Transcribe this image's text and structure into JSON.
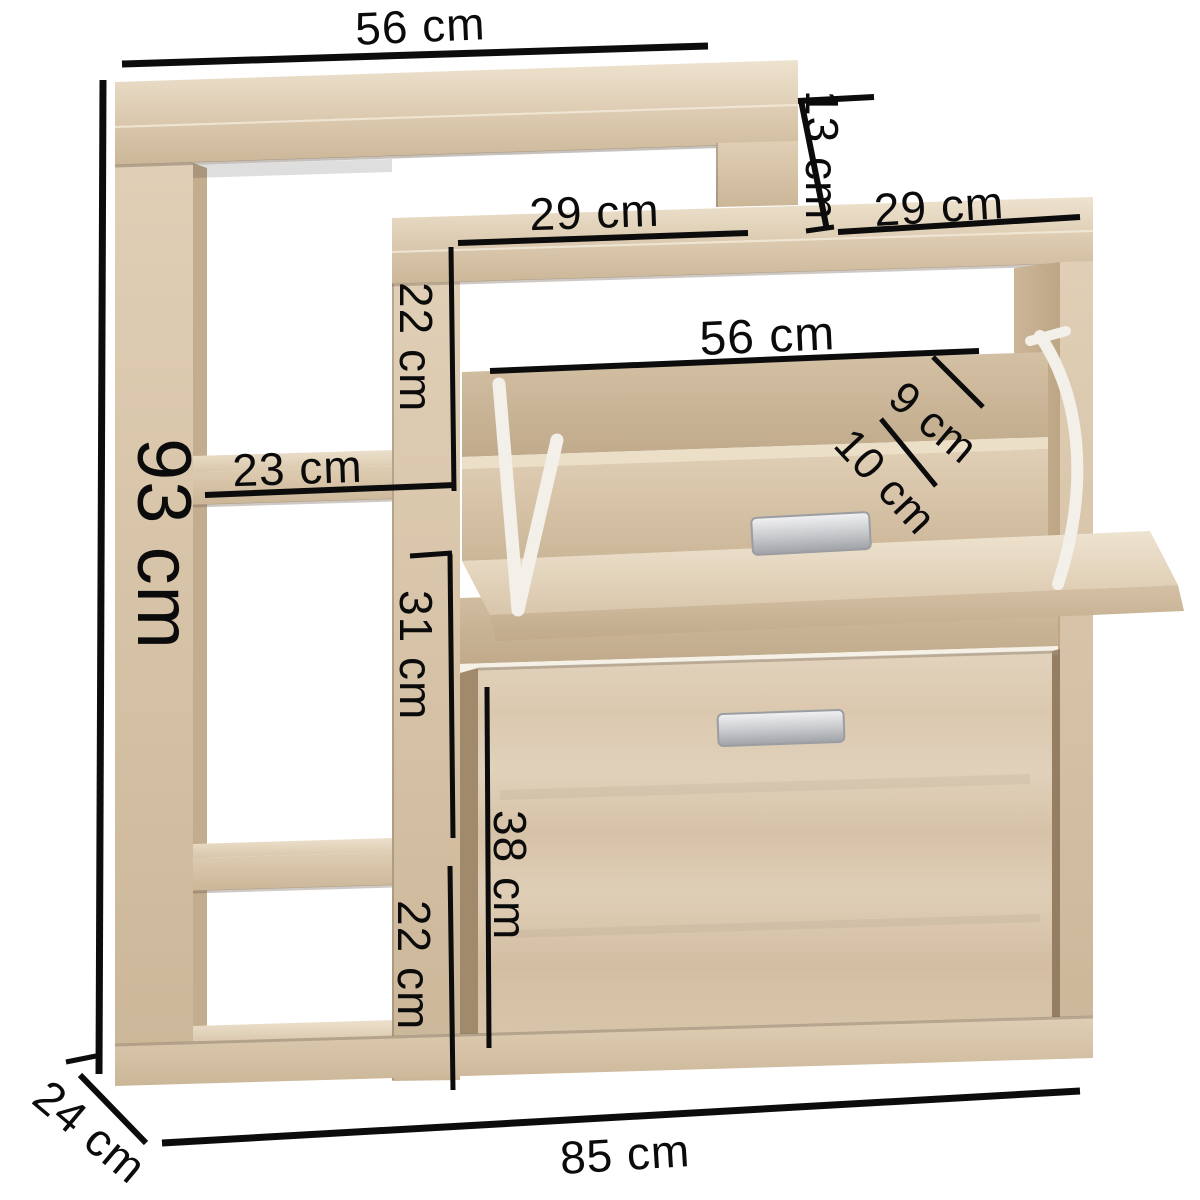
{
  "diagram": {
    "subject": "shoe-cabinet-dimension-diagram",
    "unit": "cm"
  },
  "dimensions": {
    "top_width": {
      "label": "56 cm"
    },
    "step_height": {
      "label": "13 cm"
    },
    "shelf_depth_left": {
      "label": "29 cm"
    },
    "shelf_depth_right": {
      "label": "29 cm"
    },
    "flap_width": {
      "label": "56 cm"
    },
    "flap_edge_top": {
      "label": "9 cm"
    },
    "flap_edge_bottom": {
      "label": "10 cm"
    },
    "total_height": {
      "label": "93 cm"
    },
    "compartment_top_height": {
      "label": "22 cm"
    },
    "compartment_width": {
      "label": "23 cm"
    },
    "compartment_middle_height": {
      "label": "31 cm"
    },
    "compartment_bottom_height": {
      "label": "22 cm"
    },
    "door_height": {
      "label": "38 cm"
    },
    "depth": {
      "label": "24 cm"
    },
    "total_width": {
      "label": "85 cm"
    }
  },
  "colors": {
    "background": "#ffffff",
    "dimension_line": "#0c0c0c",
    "wood_light": "#e9ddc8",
    "wood_mid": "#d8c5aa",
    "wood_dark": "#c4ae90",
    "hinge_white": "#f3f0e9",
    "handle_silver": "#c9cbcd"
  }
}
